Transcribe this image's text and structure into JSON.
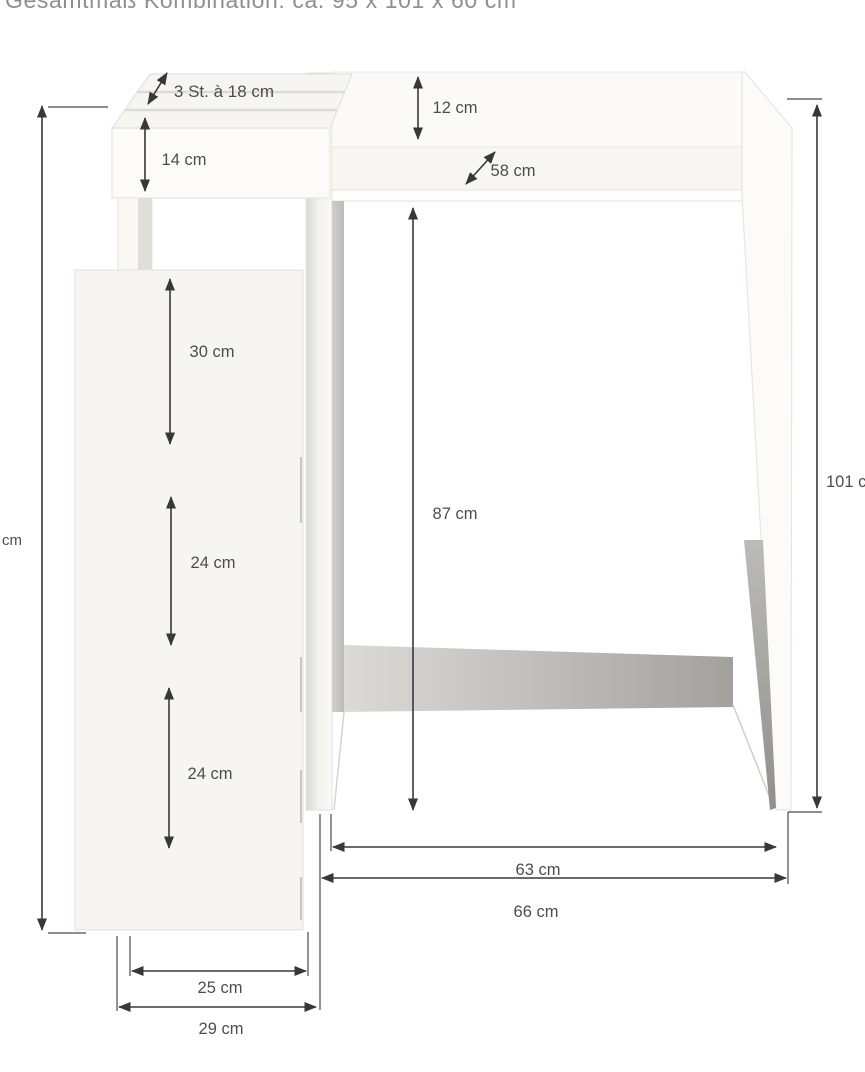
{
  "title": "Gesamtmaß Kombination: ca. 95 x 101 x 60 cm",
  "labels": {
    "compartments": "3 St. à 18 cm",
    "box_height": "14 cm",
    "riser_height": "12 cm",
    "top_depth": "58 cm",
    "left_total_height": "cm",
    "shelf_gap_1": "30 cm",
    "shelf_gap_2": "24 cm",
    "shelf_gap_3": "24 cm",
    "clearance_height": "87 cm",
    "total_height": "101 cm",
    "inner_width": "63 cm",
    "outer_width": "66 cm",
    "side_unit_width": "25 cm",
    "side_unit_outer_width": "29 cm"
  },
  "colors": {
    "background": "#ffffff",
    "dimension_lines": "#383838",
    "label_text": "#4d4d4d",
    "title_text": "#8f8f8f",
    "panel_fill": "#f6f5f1",
    "shadow_gray": "#a8a7a3"
  }
}
